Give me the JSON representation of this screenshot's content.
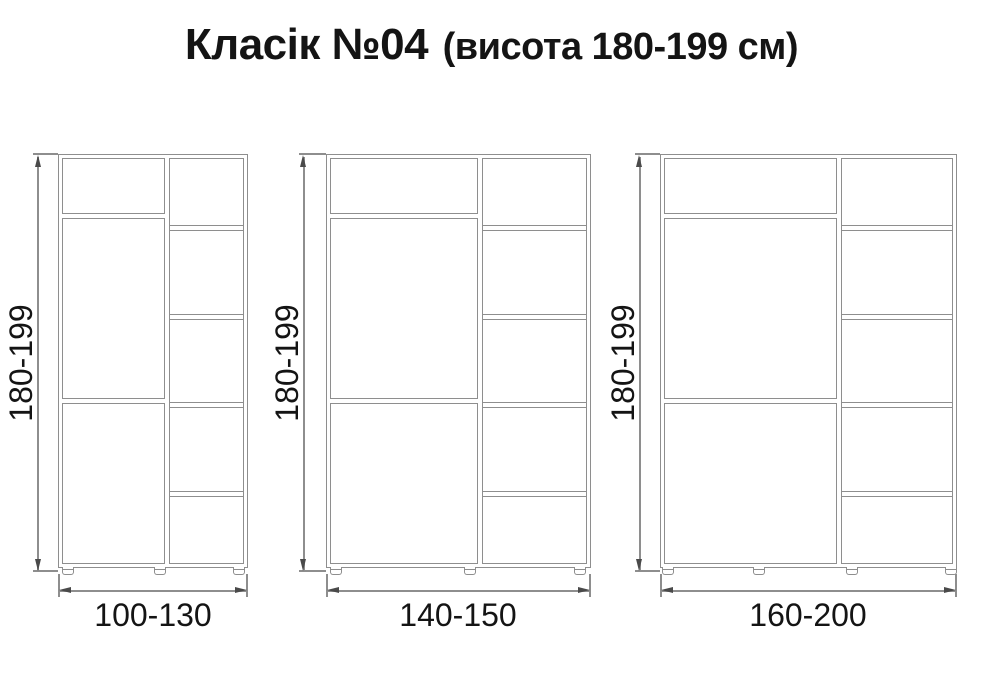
{
  "title": {
    "main": "Класік №04",
    "suffix": "(висота 180-199 см)"
  },
  "colors": {
    "outline": "#8e8e8e",
    "arrow": "#4a4a4a",
    "text": "#141414"
  },
  "wardrobes": [
    {
      "id": "small",
      "height_label": "180-199",
      "width_label": "100-130"
    },
    {
      "id": "medium",
      "height_label": "180-199",
      "width_label": "140-150"
    },
    {
      "id": "large",
      "height_label": "180-199",
      "width_label": "160-200"
    }
  ]
}
